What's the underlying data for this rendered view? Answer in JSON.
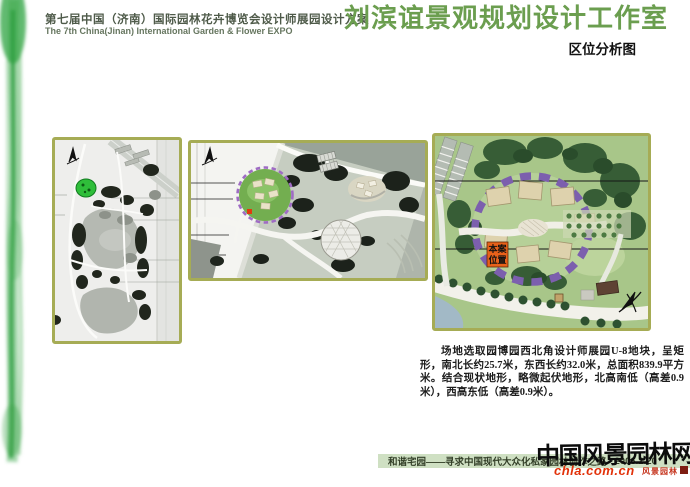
{
  "header": {
    "project_title_cn": "第七届中国（济南）国际园林花卉博览会设计师展园设计方案",
    "project_title_en": "The 7th China(Jinan) International Garden & Flower EXPO",
    "studio_title": "刘滨谊景观规划设计工作室",
    "sheet_title": "区位分析图"
  },
  "site_note": {
    "text": "场地选取园博园西北角设计师展园U-8地块，呈矩形，南北长约25.7米，东西长约32.0米，总面积839.9平方米。结合现状地形，略微起伏地形，北高南低（高差0.9米），西高东低（高差0.9米）。"
  },
  "maps": {
    "location_label": {
      "line1": "本案",
      "line2": "位置"
    }
  },
  "footer": {
    "slogan": "和谐宅园——寻求中国现代大众化私家园林创作之路",
    "date": "2006.2.20"
  },
  "watermark": {
    "site_name": "中国风景园林网",
    "site_url": "chla.com.cn",
    "script_text": "风景园林"
  },
  "colors": {
    "studio_title_green": "#6b9e4f",
    "panel_border_olive": "#a6ac55",
    "footer_bar_green": "#cfe0c3",
    "url_red": "#e2320a",
    "site_highlight_green": "#2fbe3a",
    "ring_purple": "#7c5fae",
    "location_label_orange": "#e8611a"
  }
}
